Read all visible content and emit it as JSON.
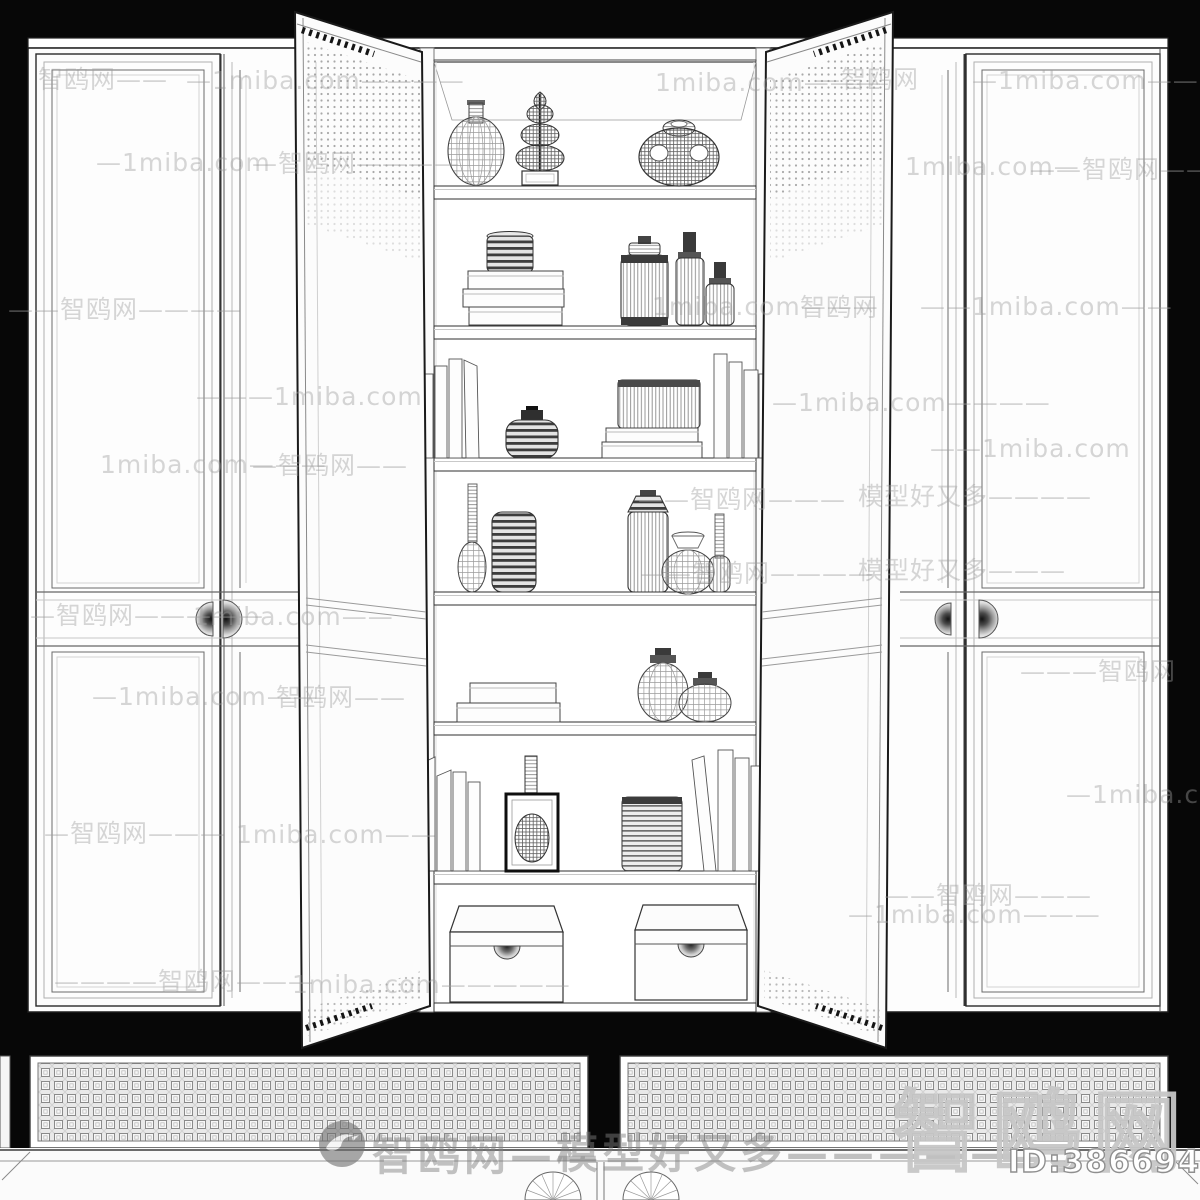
{
  "meta": {
    "image_kind": "3d-model-wireframe-product-preview",
    "subject": "two-door-open wardrobe bookcase wireframe render",
    "background_color": "#070707",
    "furniture_color": "#fcfcfc",
    "line_color": "#2a2a2a",
    "watermark_color": "#9e9e9e"
  },
  "footer": {
    "brand_watermark": "智鸥网——",
    "slogan_watermark": "模型好又多—————",
    "brand_large": "智鸥网",
    "model_id": "ID:386694916"
  },
  "watermarks": [
    {
      "t": "智鸥网——",
      "x": 38,
      "y": 60
    },
    {
      "t": "—1miba.com————",
      "x": 186,
      "y": 66
    },
    {
      "t": "1miba.com———",
      "x": 655,
      "y": 68
    },
    {
      "t": "—智鸥网",
      "x": 815,
      "y": 60
    },
    {
      "t": "—1miba.com——",
      "x": 972,
      "y": 66
    },
    {
      "t": "—1miba.com",
      "x": 96,
      "y": 148
    },
    {
      "t": "—智鸥网————",
      "x": 252,
      "y": 144
    },
    {
      "t": "1miba.com—",
      "x": 905,
      "y": 152
    },
    {
      "t": "——智鸥网———",
      "x": 1030,
      "y": 150
    },
    {
      "t": "——智鸥网————",
      "x": 8,
      "y": 290
    },
    {
      "t": "1miba.com———",
      "x": 652,
      "y": 292
    },
    {
      "t": "智鸥网",
      "x": 800,
      "y": 288
    },
    {
      "t": "——1miba.com——",
      "x": 920,
      "y": 292
    },
    {
      "t": "———1miba.com",
      "x": 196,
      "y": 382
    },
    {
      "t": "—1miba.com————",
      "x": 772,
      "y": 388
    },
    {
      "t": "1miba.com———",
      "x": 100,
      "y": 450
    },
    {
      "t": "—智鸥网——",
      "x": 252,
      "y": 446
    },
    {
      "t": "——1miba.com",
      "x": 930,
      "y": 434
    },
    {
      "t": "——智鸥网———",
      "x": 638,
      "y": 480
    },
    {
      "t": "模型好又多————",
      "x": 858,
      "y": 477
    },
    {
      "t": "—智鸥网—————",
      "x": 30,
      "y": 596
    },
    {
      "t": "1miba.com——",
      "x": 193,
      "y": 602
    },
    {
      "t": "——智鸥网————",
      "x": 640,
      "y": 554
    },
    {
      "t": "模型好又多———",
      "x": 858,
      "y": 551
    },
    {
      "t": "—1miba.com——",
      "x": 92,
      "y": 682
    },
    {
      "t": "智鸥网——",
      "x": 276,
      "y": 678
    },
    {
      "t": "———智鸥网",
      "x": 1020,
      "y": 652
    },
    {
      "t": "—1miba.com",
      "x": 1066,
      "y": 780
    },
    {
      "t": "—智鸥网———",
      "x": 44,
      "y": 814
    },
    {
      "t": "1miba.com——",
      "x": 236,
      "y": 820
    },
    {
      "t": "——智鸥网———",
      "x": 884,
      "y": 876
    },
    {
      "t": "—1miba.com———",
      "x": 848,
      "y": 900
    },
    {
      "t": "————智鸥网———",
      "x": 54,
      "y": 962
    },
    {
      "t": "1miba.com—————",
      "x": 292,
      "y": 970
    }
  ]
}
